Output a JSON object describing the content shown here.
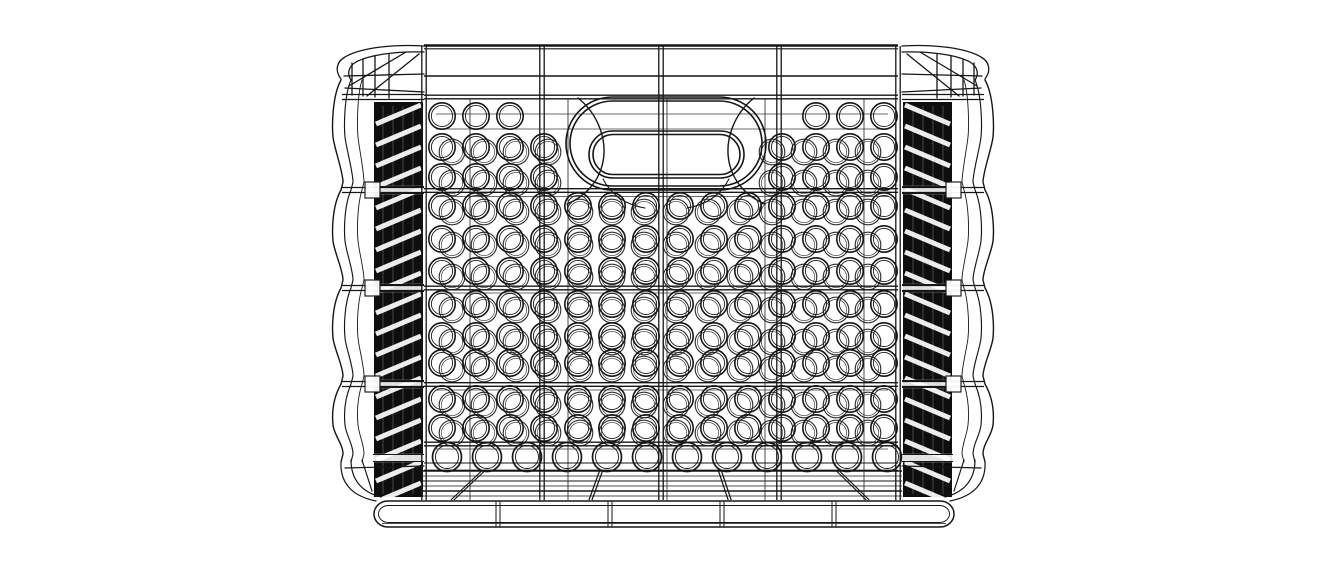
{
  "meta": {
    "alt_text": "Black and white CAD wireframe rendering of a rectangular plastic storage crate with round perforation holes, a central oval carry-handle cutout, corrugated dark side walls and a ribbed base skirt, shown straight-on in front view on a white background",
    "background": "#ffffff",
    "line_color": "#161616",
    "canvas": {
      "w": 1334,
      "h": 578
    }
  },
  "crate": {
    "center_x": 663,
    "front": {
      "left": 424,
      "right": 898,
      "top": 46,
      "bottom": 500,
      "posts": [
        424,
        542,
        661,
        779,
        898
      ],
      "back_posts": [
        470,
        568,
        667,
        765,
        864
      ],
      "rim": {
        "top_y": 45.5,
        "top2_y": 48.8,
        "mid_y": 76
      },
      "rails": [
        97,
        190.5,
        288,
        384.5,
        444
      ],
      "thin_rails": [
        463,
        470.5
      ],
      "back_rails": [
        114,
        129,
        196.5,
        293,
        390,
        449
      ]
    },
    "handle": {
      "stadiums": [
        {
          "x": 566,
          "y": 97,
          "w": 200,
          "h": 93
        },
        {
          "x": 570,
          "y": 101,
          "w": 192,
          "h": 85
        },
        {
          "x": 589,
          "y": 131,
          "w": 155,
          "h": 47
        },
        {
          "x": 593,
          "y": 134.5,
          "w": 147,
          "h": 40
        }
      ],
      "flank_arcs": [
        "M 578,98 C 597,113 609,140 602,166 C 597,184 584,197 567,204",
        "M 754,98 C 735,113 723,140 730,166 C 735,184 748,197 765,204"
      ],
      "extra_arcs": [
        "M 603,179 C 612,196 627,205 645,208",
        "M 729,179 C 720,196 705,205 687,208"
      ]
    },
    "circles": {
      "front": {
        "r": 13.2,
        "pitch": 34,
        "start_x": 442,
        "cols": 14,
        "rows": [
          116,
          147,
          177,
          206,
          239,
          271,
          304,
          336,
          363,
          399,
          428
        ],
        "masks": [
          {
            "rows": [
              116
            ],
            "x1": 533,
            "x2": 802
          },
          {
            "rows": [
              147,
              177
            ],
            "x1": 550,
            "x2": 776
          }
        ]
      },
      "back": {
        "r": 12.8,
        "pitch": 32,
        "start_x": 452,
        "cols": 14,
        "rows": [
          152,
          183,
          212,
          245,
          277,
          310,
          342,
          369,
          405,
          433
        ],
        "masks": [
          {
            "rows": [
              152,
              183
            ],
            "x1": 562,
            "x2": 768
          }
        ]
      },
      "bottom_row": {
        "r": 14.5,
        "pitch": 40,
        "start_x": 447,
        "cols": 12,
        "y": 457
      }
    },
    "sides": {
      "band": {
        "x1": 374,
        "x2": 423,
        "top": 102,
        "bottom": 497
      },
      "stripe_period": 21,
      "stripe_width": 5,
      "hairline_xs": [
        383,
        393,
        403,
        413
      ],
      "rail_breaks": [
        190,
        288,
        384,
        458
      ],
      "side_rails": [
        97,
        190,
        288,
        384
      ],
      "wave": {
        "xs": [
          341,
          351,
          362
        ],
        "amps": [
          9,
          7,
          5
        ],
        "top": 80,
        "bottom": 462,
        "notches": [
          190,
          288,
          384
        ]
      },
      "flare_paths": [
        "M 424,46 C 392,44 360,48 345,57 C 336,62 335,71 341,79",
        "M 424,52 C 396,51 369,55 356,62 C 348,67 347,74 351,80",
        "M 419,54 L 367,96",
        "M 406,52 L 349,86",
        "M 352,63 L 352,95",
        "M 363,59 L 363,96",
        "M 375,56 L 375,97",
        "M 389,54 L 389,98",
        "M 344,76 L 424,74",
        "M 345,88 L 424,92"
      ],
      "bottom_paths": [
        "M 341,462 C 340,482 351,496 376,501",
        "M 351,460 C 351,479 361,492 381,497",
        "M 362,460 L 372,491",
        "M 345,468 L 424,466"
      ]
    },
    "base": {
      "floor": {
        "x1": 420,
        "x2": 902,
        "lines": [
          471,
          476,
          481,
          486,
          491,
          496
        ]
      },
      "ribs": {
        "top_y": 471,
        "bottom_y": 500,
        "spread": 1.17,
        "top_xs": [
          483,
          601,
          720,
          838
        ]
      },
      "skirt": {
        "x": 374,
        "y": 501,
        "w": 580,
        "h": 26,
        "r": 14,
        "ticks": [
          498,
          610,
          722,
          834
        ]
      }
    }
  }
}
